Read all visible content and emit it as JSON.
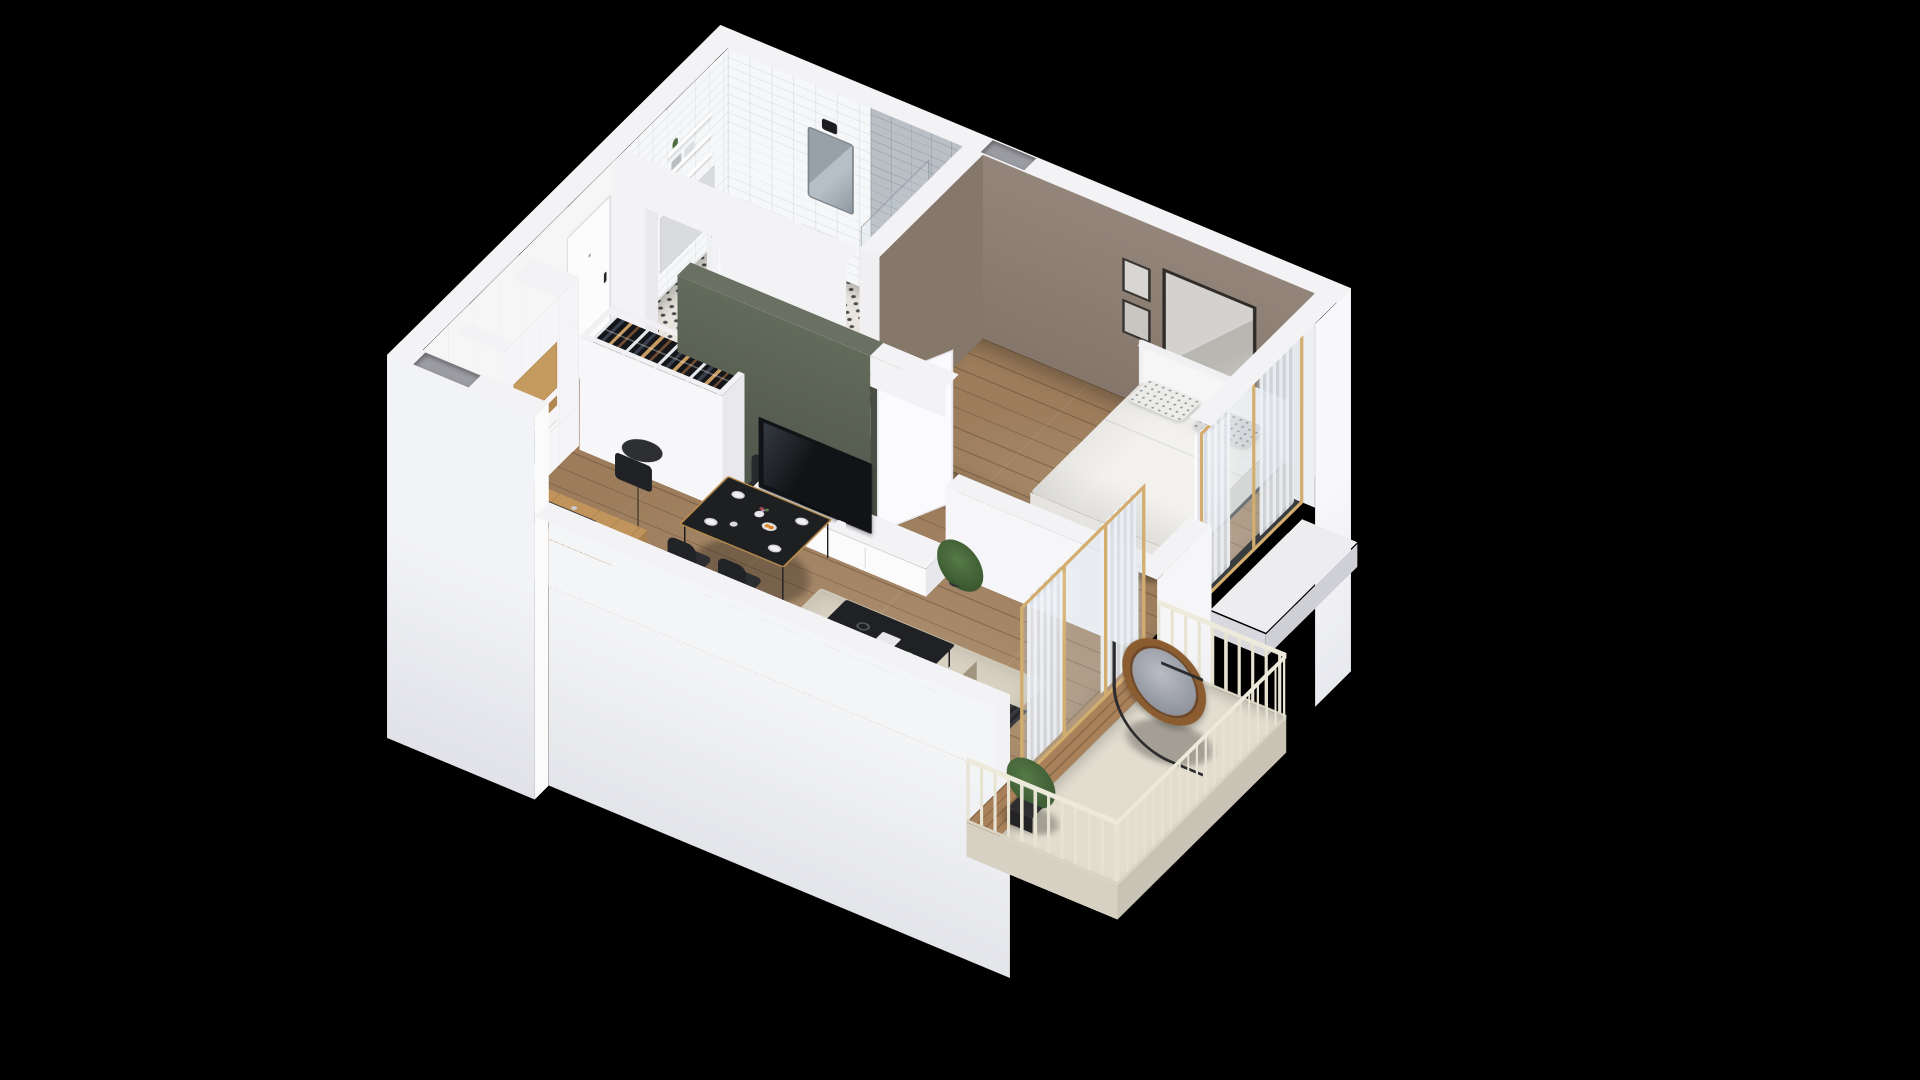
{
  "scene": {
    "description": "3D isometric cutaway floor plan of a one-bedroom apartment with balcony, rendered on a black background",
    "background": "#000000",
    "projection": "isometric-cutaway",
    "visible_text": ""
  },
  "palette": {
    "background": "#000000",
    "wall_white_top": "#f3f3f5",
    "wall_white_lit": "#fafafb",
    "wall_white_medium": "#ececf0",
    "wall_white_shade": "#dddde3",
    "interior_wall": "#f4f3f5",
    "wood_floor": "#9c7c5b",
    "oak_cabinet": "#c59a5f",
    "taupe_bedroom_wall": "#8d7f73",
    "green_accent_wall": "#5a6153",
    "gold_window_frame": "#d3ad6e",
    "white_tile": "#f6f7f8",
    "grey_shower_tile": "#b9bfc5",
    "patterned_bath_floor": "#eae6df",
    "balcony_floor_cream": "#e2ddcf",
    "railing_cream": "#e9e5d4",
    "dark_furniture": "#1d1e20",
    "sofa_beige": "#b5a795",
    "rug_beige": "#d8d1c2",
    "duvet_white": "#f3f2ef",
    "rattan_chair": "#8a5c30"
  },
  "rooms": {
    "entry_hall": {
      "label": "Entry hall",
      "furniture": [
        "front door",
        "open wardrobe with hanging clothes",
        "wood floor"
      ]
    },
    "bathroom": {
      "label": "Bathroom",
      "furniture": [
        "washing machine",
        "vanity with sink",
        "mirror",
        "bathtub",
        "glass shower",
        "towel shelves",
        "patterned tile floor"
      ]
    },
    "bedroom": {
      "label": "Bedroom",
      "furniture": [
        "double bed with white duvet",
        "white headboard",
        "patterned pillows",
        "three framed artworks",
        "gold-framed window",
        "white curtains",
        "open wardrobe with hanging clothes"
      ]
    },
    "living_room": {
      "label": "Living room with open kitchen",
      "furniture": [
        "tall kitchen cabinets",
        "oak counter with induction cooktop",
        "built-in oven",
        "oak peninsula with black sink",
        "black dining table",
        "four black chairs",
        "floor lamp",
        "white TV sideboard",
        "flat-screen TV",
        "green accent wall",
        "beige sofa",
        "beige rug",
        "black coffee table",
        "radiator",
        "gold-framed sliding glass doors"
      ]
    },
    "balcony": {
      "label": "Balcony",
      "furniture": [
        "hanging rattan egg chair",
        "cream railing",
        "planter box",
        "wood deck strip"
      ]
    }
  }
}
